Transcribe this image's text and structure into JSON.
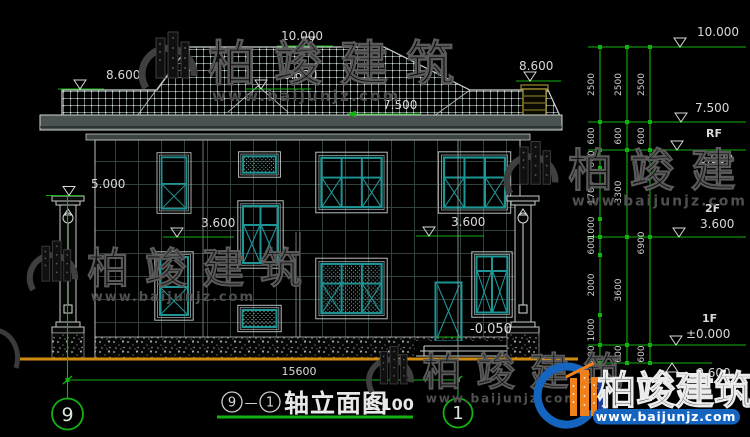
{
  "title": {
    "axis_start": "9",
    "dash": "—",
    "axis_end": "1",
    "name": "轴立面图",
    "scale": "1:100"
  },
  "levels": {
    "ridge": "10.000",
    "eave_left": "8.600",
    "eave_mid": "8.600",
    "eave_right": "8.600",
    "roof_inner": "7.500",
    "column_top": "5.000",
    "floor2_left": "3.600",
    "floor2_right": "3.600",
    "door_sill": "-0.050"
  },
  "right_panel": {
    "e10": "10.000",
    "e75": "7.500",
    "e69": "6.900",
    "e36": "3.600",
    "e0": "±0.000",
    "elow": "-0.600",
    "rf": "RF",
    "f2": "2F",
    "f1": "1F",
    "chain1": [
      "2500",
      "600",
      "600",
      "1700",
      "1000",
      "600",
      "2000",
      "1000",
      "600"
    ],
    "chain2": [
      "2500",
      "600",
      "3300",
      "3600",
      "600"
    ],
    "chain3": [
      "2500",
      "600",
      "6900",
      "600"
    ]
  },
  "bottom": {
    "overall": "15600",
    "axis_left": "9",
    "axis_right": "1"
  },
  "watermark": {
    "brand": "柏竣建筑",
    "url": "www.baijunjz.com"
  },
  "colors": {
    "dim_green": "#12b212",
    "window_teal": "#1e9595",
    "ground_orange": "#cf8a10",
    "text_white": "#d9d9d9",
    "chimney_yellow": "#9b8b2e",
    "brand_blue": "#1565c0",
    "brand_orange": "#f08019"
  }
}
